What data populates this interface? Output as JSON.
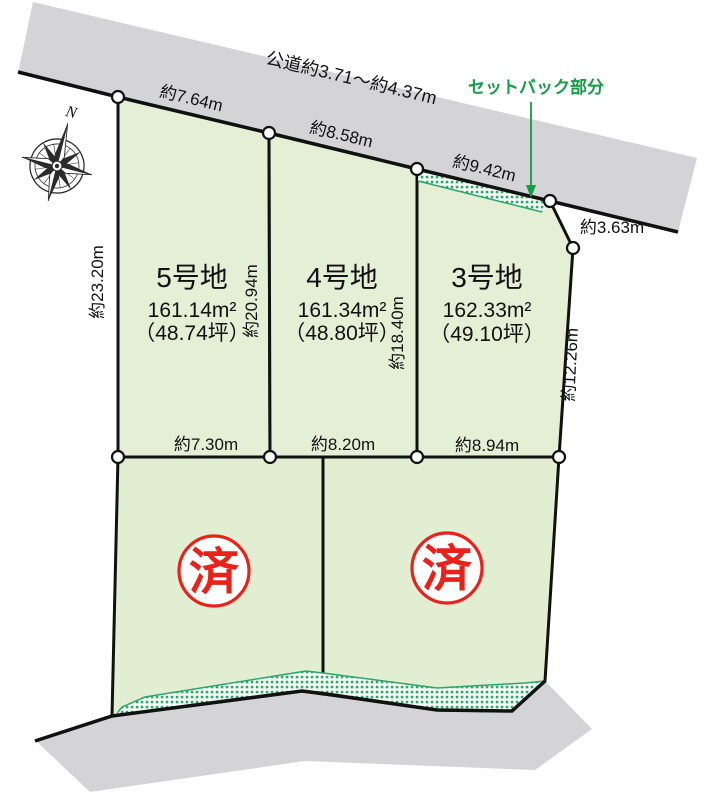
{
  "colors": {
    "lot_fill": "#e4efd6",
    "road_fill": "#d4d4d6",
    "hatch_green": "#2aa56b",
    "boundary_black": "#111111",
    "stamp_red": "#e8211a",
    "setback_green": "#169b46"
  },
  "compass": {
    "north_label": "N"
  },
  "road": {
    "label": "公道約3.71～約4.37m"
  },
  "setback": {
    "label": "セットバック部分"
  },
  "lots": {
    "lot5": {
      "name": "5号地",
      "area": "161.14m²",
      "tsubo": "（48.74坪）"
    },
    "lot4": {
      "name": "4号地",
      "area": "161.34m²",
      "tsubo": "（48.80坪）"
    },
    "lot3": {
      "name": "3号地",
      "area": "162.33m²",
      "tsubo": "（49.10坪）"
    },
    "sold_left": {
      "stamp": "済"
    },
    "sold_right": {
      "stamp": "済"
    }
  },
  "dimensions": {
    "top_lot5": "約7.64m",
    "top_lot4": "約8.58m",
    "top_lot3": "約9.42m",
    "corner_lot3": "約3.63m",
    "left_side": "約23.20m",
    "depth_lot5": "約20.94m",
    "depth_lot4": "約18.40m",
    "right_side": "約12.26m",
    "bottom_lot5": "約7.30m",
    "bottom_lot4": "約8.20m",
    "bottom_lot3": "約8.94m"
  }
}
